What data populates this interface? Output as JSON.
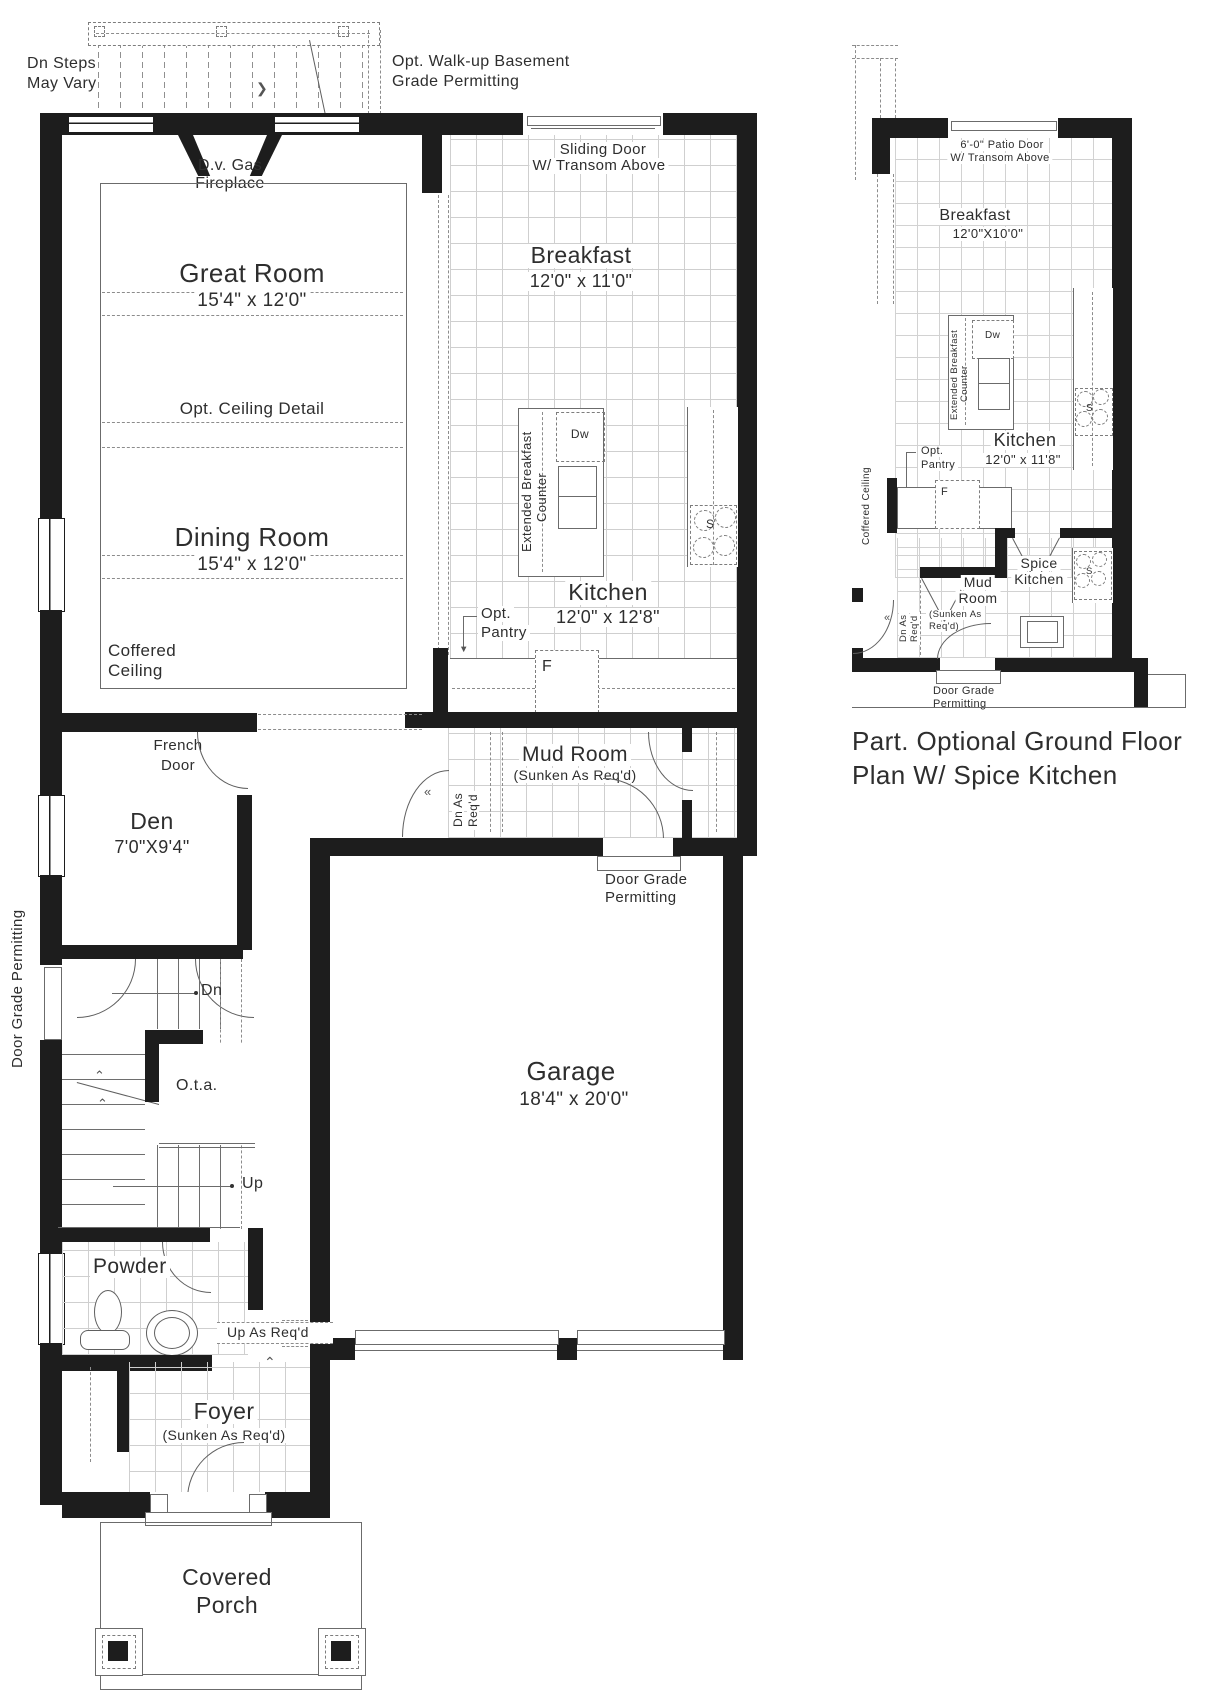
{
  "colors": {
    "wall": "#1d1d1d",
    "line": "#5f5f5f",
    "tile": "#cfcfcf",
    "text": "#2e2e2e"
  },
  "glyphs": {
    "deck_arrow": "❯",
    "swing_mark": "«",
    "step_chevron": "⌃",
    "pantry_arrow": "▼"
  },
  "main": {
    "rooms": {
      "great": {
        "name": "Great Room",
        "dims": "15'4\" x 12'0\""
      },
      "dining": {
        "name": "Dining Room",
        "dims": "15'4\" x 12'0\""
      },
      "breakfast": {
        "name": "Breakfast",
        "dims": "12'0\" x 11'0\""
      },
      "kitchen": {
        "name": "Kitchen",
        "dims": "12'0\" x 12'8\""
      },
      "den": {
        "name": "Den",
        "dims": "7'0\"X9'4\""
      },
      "mud": {
        "name": "Mud Room",
        "sunken": "(Sunken As Req'd)"
      },
      "garage": {
        "name": "Garage",
        "dims": "18'4\" x 20'0\""
      },
      "powder": {
        "name": "Powder"
      },
      "foyer": {
        "name": "Foyer",
        "sunken": "(Sunken As Req'd)"
      },
      "porch": {
        "line1": "Covered",
        "line2": "Porch"
      }
    },
    "notes": {
      "dn_steps1": "Dn Steps",
      "dn_steps2": "May Vary",
      "walkup1": "Opt. Walk-up Basement",
      "walkup2": "Grade Permitting",
      "sliding1": "Sliding Door",
      "sliding2": "W/ Transom Above",
      "fireplace1": "D.v. Gas",
      "fireplace2": "Fireplace",
      "opt_ceiling": "Opt. Ceiling Detail",
      "coffered1": "Coffered",
      "coffered2": "Ceiling",
      "french1": "French",
      "french2": "Door",
      "ext_counter1": "Extended Breakfast",
      "ext_counter2": "Counter",
      "dw": "Dw",
      "fridge": "F",
      "stove": "S",
      "pantry1": "Opt.",
      "pantry2": "Pantry",
      "dn_as1": "Dn As",
      "dn_as2": "Req'd",
      "door_grade1": "Door Grade",
      "door_grade2": "Permitting",
      "door_grade_side": "Door Grade Permitting",
      "dn": "Dn",
      "up": "Up",
      "ota": "O.t.a.",
      "up_as_reqd": "Up As Req'd"
    }
  },
  "optional": {
    "caption1": "Part. Optional Ground Floor",
    "caption2": "Plan W/ Spice Kitchen",
    "rooms": {
      "breakfast": {
        "name": "Breakfast",
        "dims": "12'0\"X10'0\""
      },
      "kitchen": {
        "name": "Kitchen",
        "dims": "12'0\" x 11'8\""
      },
      "mud1": "Mud",
      "mud2": "Room",
      "spice1": "Spice",
      "spice2": "Kitchen"
    },
    "notes": {
      "patio1": "6'-0\" Patio Door",
      "patio2": "W/ Transom Above",
      "ext_counter1": "Extended Breakfast",
      "ext_counter2": "Counter",
      "dw": "Dw",
      "fridge": "F",
      "stove": "S",
      "pantry1": "Opt.",
      "pantry2": "Pantry",
      "coffered": "Coffered Ceiling",
      "mud_sunken1": "(Sunken As",
      "mud_sunken2": "Req'd)",
      "dn_as1": "Dn As",
      "dn_as2": "Req'd",
      "door_grade1": "Door Grade",
      "door_grade2": "Permitting"
    }
  }
}
